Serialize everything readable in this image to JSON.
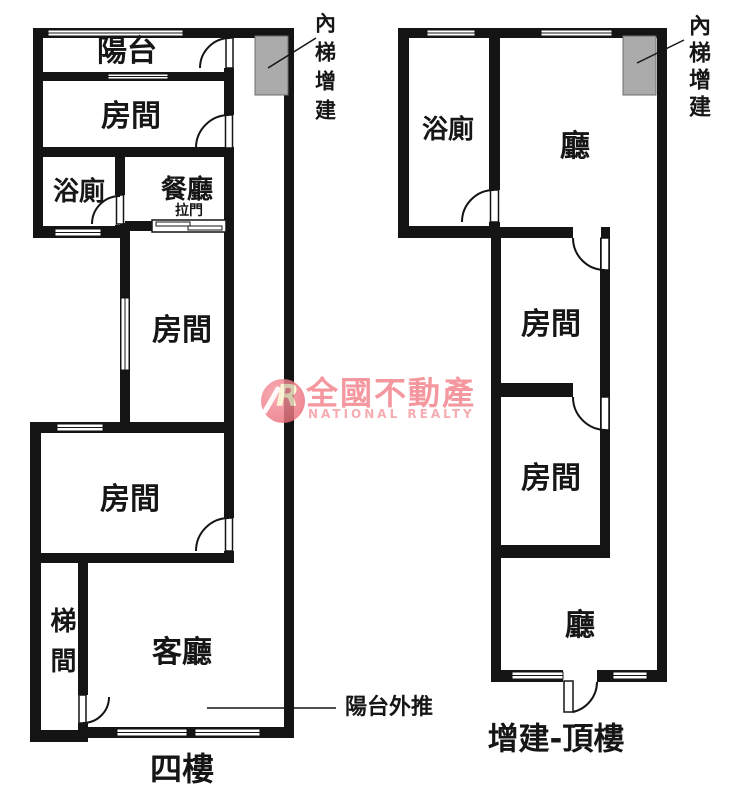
{
  "colors": {
    "wall": "#141414",
    "addition_fill": "#ababab",
    "addition_border": "#6b6b6b",
    "watermark_pink": "#f27d86",
    "watermark_pink_light": "#f5a3a9",
    "watermark_logo_letter_color": "#fcf3cc"
  },
  "plans": {
    "floor4": {
      "title": "四樓",
      "rooms": {
        "balcony": "陽台",
        "room_top": "房間",
        "bathroom": "浴廁",
        "dining": "餐廳",
        "sliding_door": "拉門",
        "room_middle": "房間",
        "room_lower": "房間",
        "stairwell": "梯間",
        "living": "客廳"
      },
      "annotations": {
        "inner_stairs_addition": "內梯增建",
        "balcony_pushed_out": "陽台外推"
      }
    },
    "rooftop": {
      "title": "增建-頂樓",
      "rooms": {
        "bathroom": "浴廁",
        "hall_upper": "廳",
        "room_upper": "房間",
        "room_lower": "房間",
        "hall_lower": "廳"
      },
      "annotations": {
        "inner_stairs_addition": "內梯增建"
      }
    }
  },
  "watermark": {
    "logo_letter": "R",
    "brand": "全國不動產",
    "brand_en": "NATIONAL REALTY"
  }
}
